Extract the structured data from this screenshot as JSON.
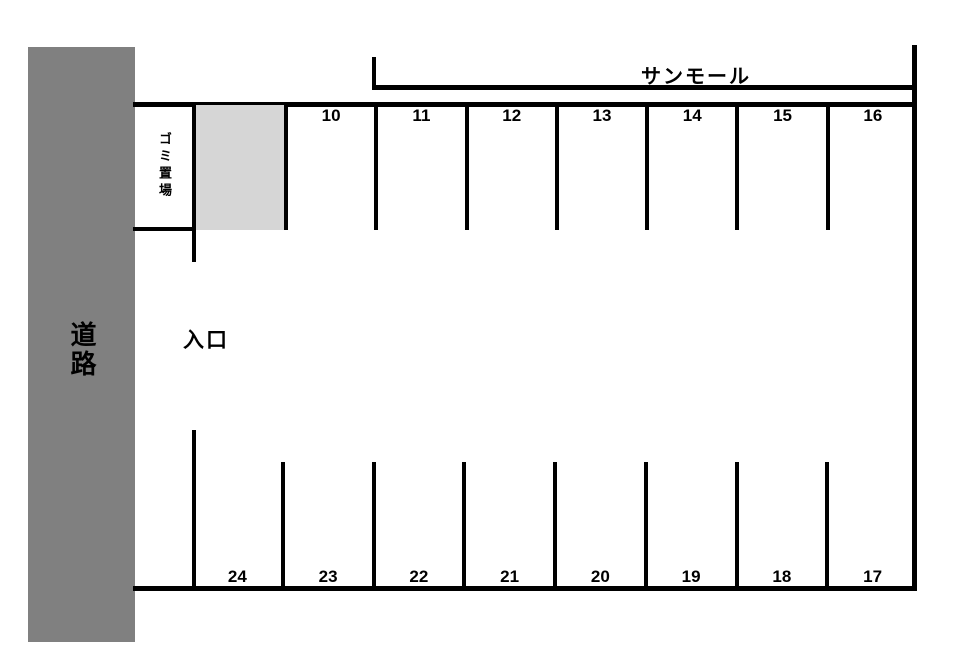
{
  "map": {
    "road_label": "道路",
    "entrance_label": "入口",
    "building_label": "サンモール",
    "garbage_label": "ゴミ置場"
  },
  "top_row": {
    "stalls": [
      {
        "number": "10"
      },
      {
        "number": "11"
      },
      {
        "number": "12"
      },
      {
        "number": "13"
      },
      {
        "number": "14"
      },
      {
        "number": "15"
      },
      {
        "number": "16"
      }
    ]
  },
  "bottom_row": {
    "stalls": [
      {
        "number": "24"
      },
      {
        "number": "23"
      },
      {
        "number": "22"
      },
      {
        "number": "21"
      },
      {
        "number": "20"
      },
      {
        "number": "19"
      },
      {
        "number": "18"
      },
      {
        "number": "17"
      }
    ]
  },
  "reserved_stall": {
    "label": ""
  },
  "colors": {
    "road": "#808080",
    "reserved_stall": "#d6d6d6",
    "line": "#000000"
  }
}
